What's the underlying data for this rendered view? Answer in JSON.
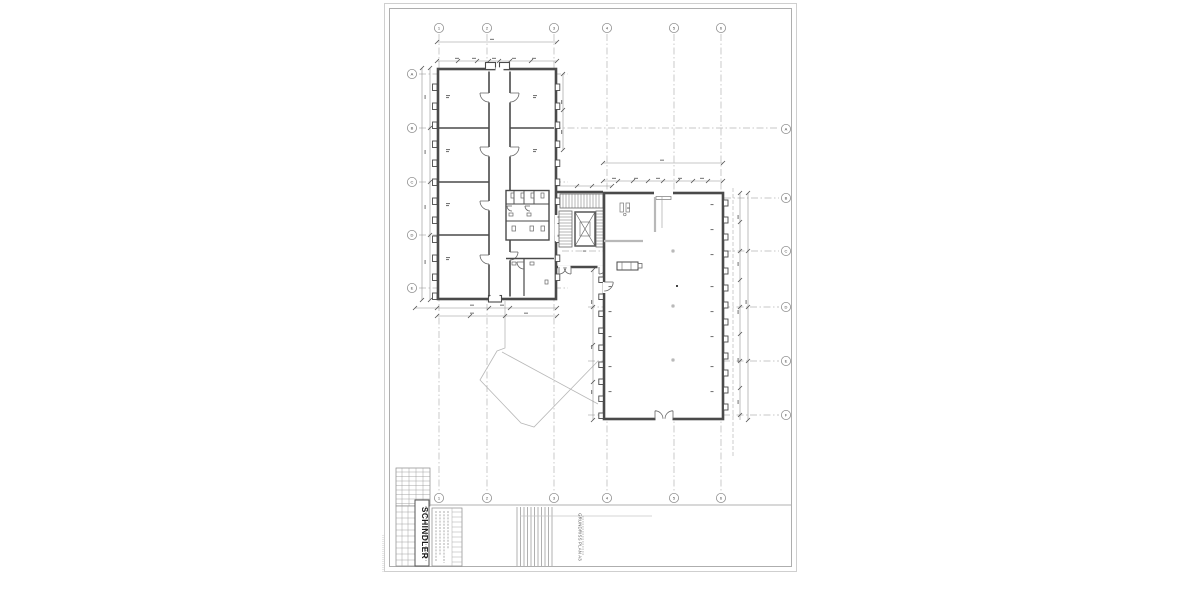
{
  "title_block": {
    "brand": "SCHINDLER",
    "drawing_title": "GRUNDRISS PLAN A3"
  },
  "grid": {
    "column_labels": [
      "1",
      "2",
      "3",
      "4",
      "5",
      "6"
    ],
    "row_labels_left": [
      "A",
      "B",
      "C",
      "D",
      "E"
    ],
    "row_labels_right": [
      "A",
      "B",
      "C",
      "D",
      "E",
      "F"
    ]
  }
}
